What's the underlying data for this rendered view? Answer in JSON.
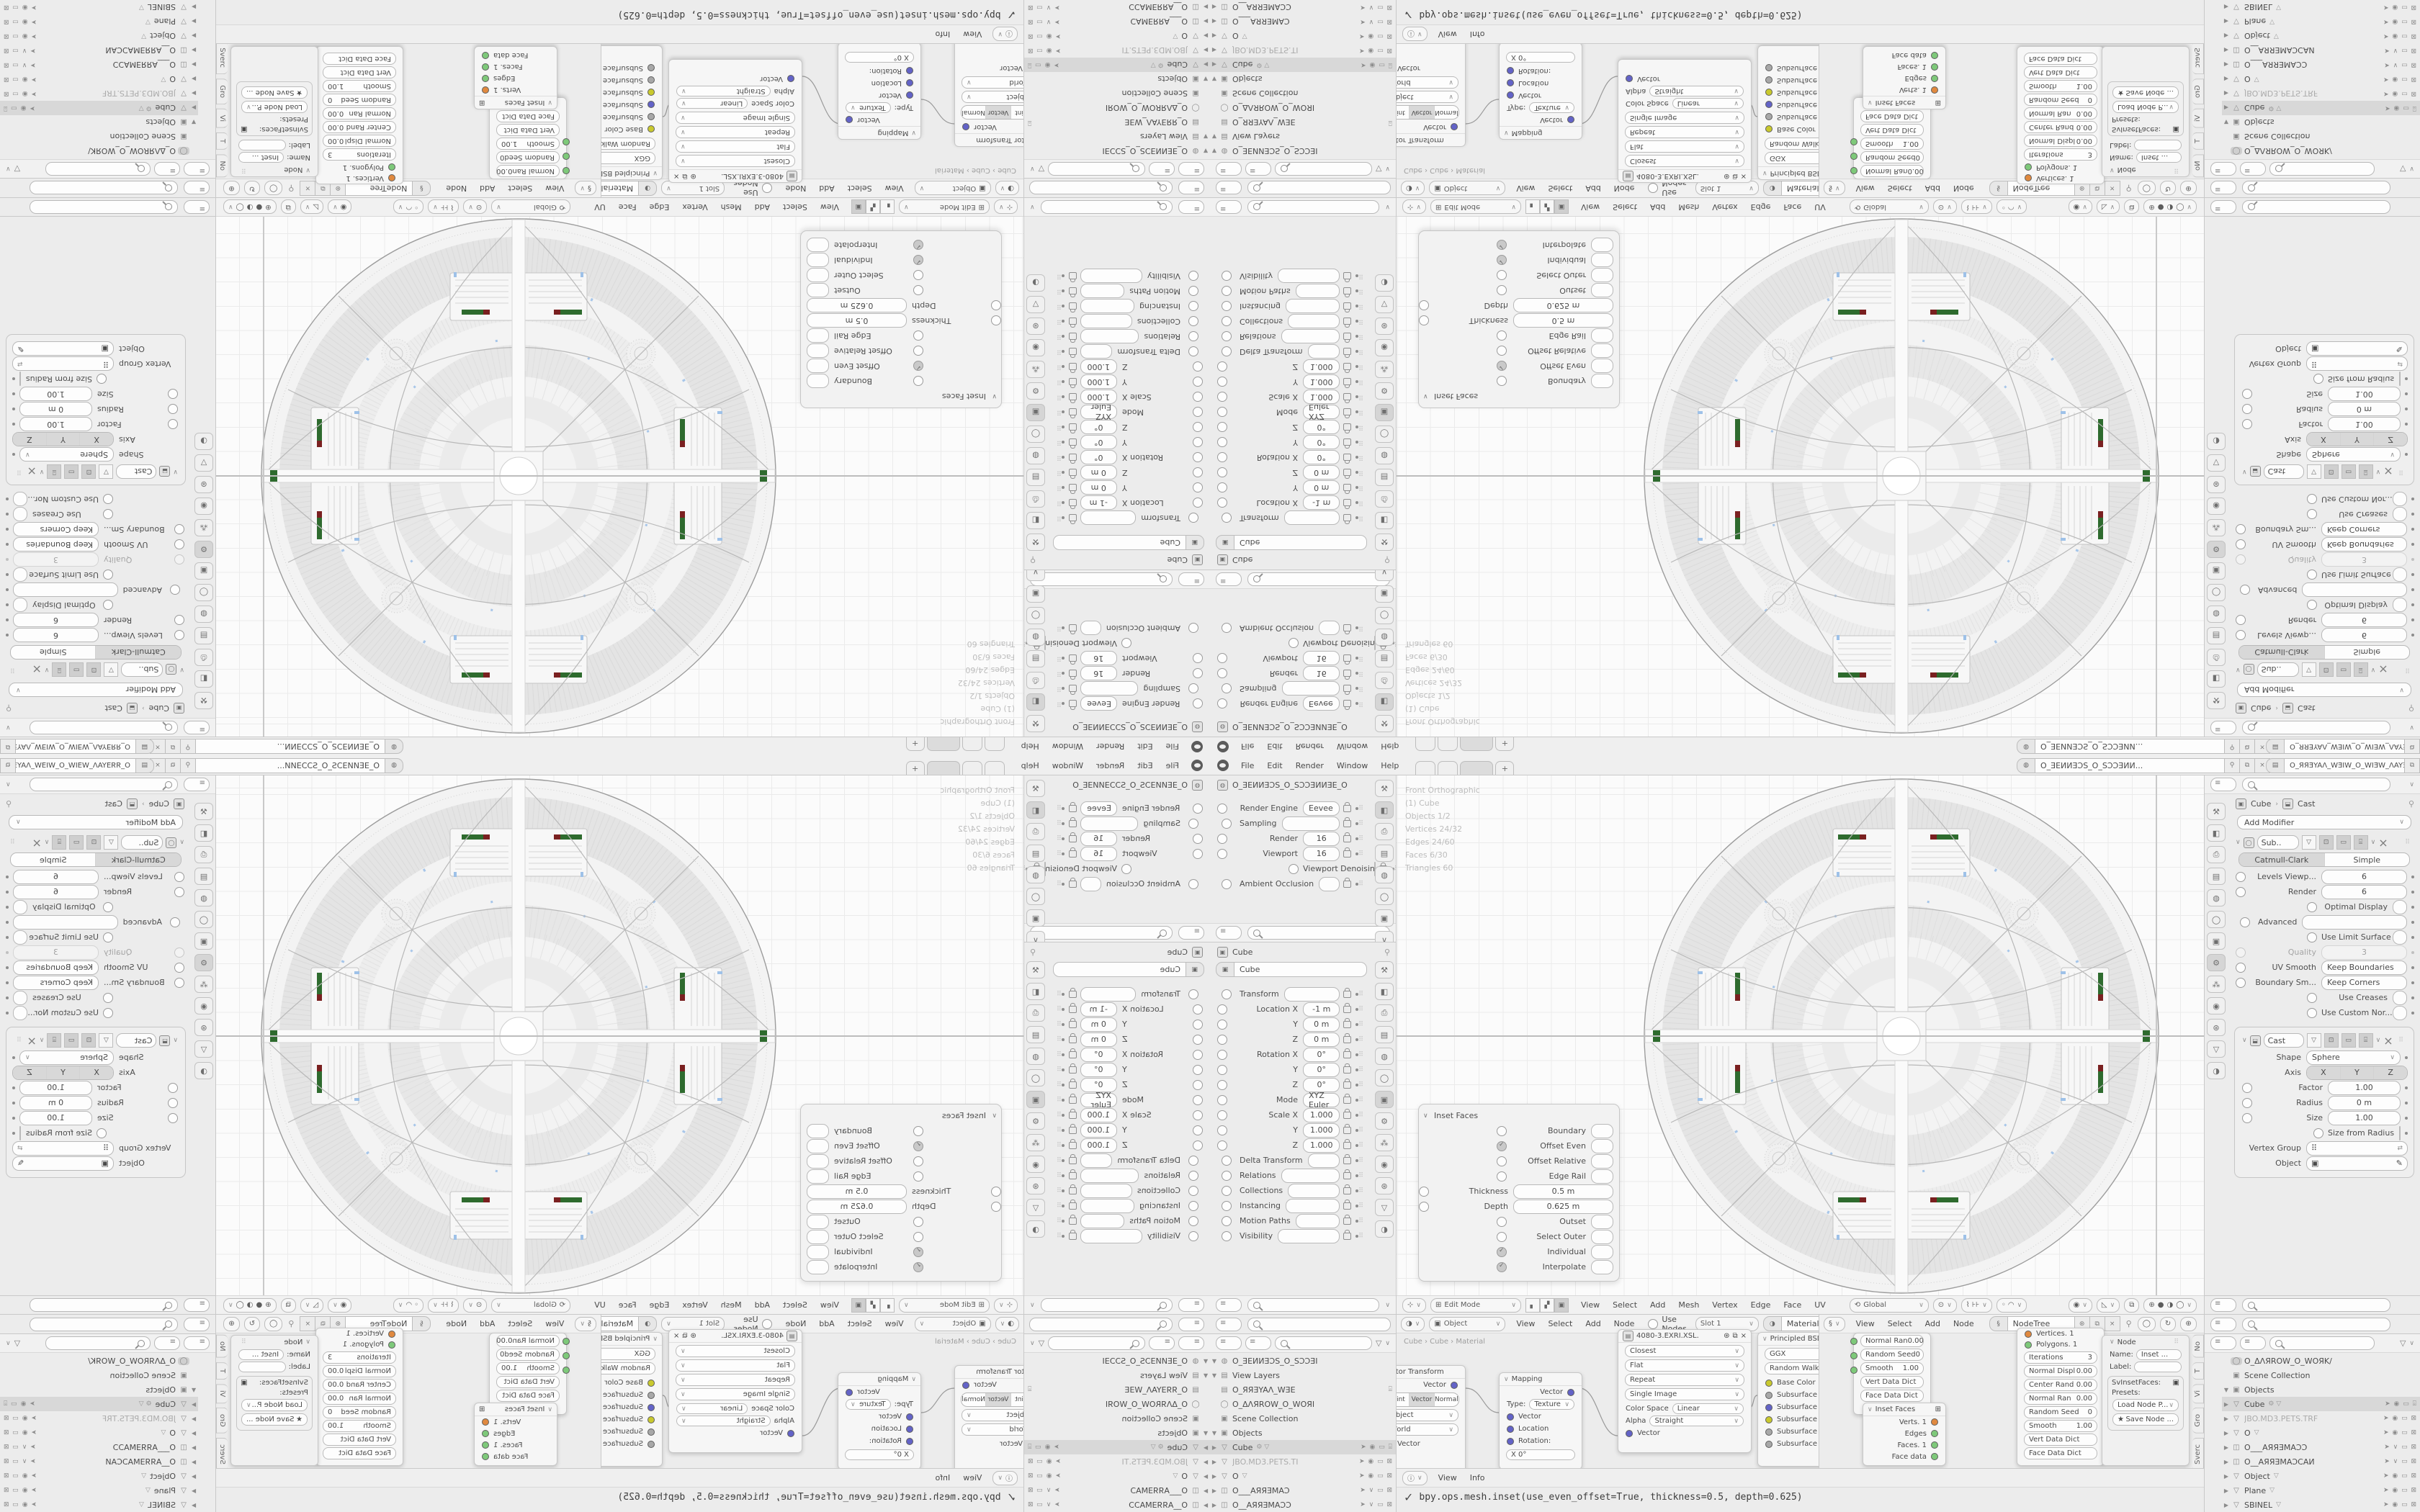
{
  "topbar": {
    "menus": [
      "File",
      "Edit",
      "Render",
      "Window",
      "Help"
    ],
    "new_tab_label": "+",
    "scene_name": "O_ƎEИИƎƆS_O_SƆƆƎИИ...",
    "view_layer_name": "O_ЯЯƎYAΛ_WƎIW_O_WIƎW_ΛAYƎЯR_O"
  },
  "icons": {
    "scene_icon": "◍",
    "view_layer_icon": "▤",
    "pin_icon": "⚲",
    "copy_icon": "⧉",
    "close_icon": "×",
    "chevron_down": "∨",
    "collapse_right": "›",
    "grip": "⠿",
    "caret_open": "∨",
    "shading_modes": [
      "⊕",
      "●",
      "◑",
      "◯"
    ],
    "gizmo_icon": "◉",
    "overlay_icon": "◺",
    "xray_icon": "⧉",
    "info_icon": "ⓘ",
    "check_icon": "✓",
    "helix_icon": "§",
    "star_icon": "★"
  },
  "tabs": {
    "render_strip": [
      {
        "g": "⚒"
      },
      {
        "g": "◧",
        "cls": "on"
      },
      {
        "g": "⎙"
      },
      {
        "g": "▤"
      },
      {
        "g": "◍"
      },
      {
        "g": "◯"
      },
      {
        "g": "▣"
      },
      {
        "g": "∨"
      }
    ],
    "object_strip": [
      {
        "g": "⚒"
      },
      {
        "g": "◧"
      },
      {
        "g": "⎙"
      },
      {
        "g": "▤"
      },
      {
        "g": "◍"
      },
      {
        "g": "◯"
      },
      {
        "g": "▣",
        "cls": "on"
      },
      {
        "g": "⚙"
      },
      {
        "g": "⁂"
      },
      {
        "g": "◉"
      },
      {
        "g": "⊛"
      },
      {
        "g": "▽"
      },
      {
        "g": "◑"
      }
    ],
    "modifier_strip": [
      {
        "g": "⚒"
      },
      {
        "g": "◧"
      },
      {
        "g": "⎙"
      },
      {
        "g": "▤"
      },
      {
        "g": "◍"
      },
      {
        "g": "◯"
      },
      {
        "g": "▣"
      },
      {
        "g": "⚙",
        "cls": "on"
      },
      {
        "g": "⁂"
      },
      {
        "g": "◉"
      },
      {
        "g": "⊛"
      },
      {
        "g": "▽"
      },
      {
        "g": "◑"
      }
    ]
  },
  "render_props": {
    "breadcrumb": "O_ƎEИИƎƆS_O_SƆƆƎИИƎE_O",
    "rows": [
      {
        "cls": "drop",
        "l": "Render Engine",
        "v": "Eevee"
      },
      {
        "cls": "head",
        "l": "Sampling"
      },
      {
        "cls": "num",
        "l": "Render",
        "v": "16"
      },
      {
        "cls": "num",
        "l": "Viewport",
        "v": "16"
      },
      {
        "cls": "chk",
        "l": "Viewport Denoising"
      },
      {
        "cls": "col chk",
        "l": "Ambient Occlusion"
      }
    ]
  },
  "object_props": {
    "breadcrumb": "Cube",
    "name_value": "Cube",
    "rows": [
      {
        "cls": "head",
        "l": "Transform"
      },
      {
        "cls": "num lk dot",
        "l": "Location X",
        "v": "-1 m"
      },
      {
        "cls": "num lk dot",
        "l": "Y",
        "v": "0 m"
      },
      {
        "cls": "num lk dot",
        "l": "Z",
        "v": "0 m"
      },
      {
        "cls": "num lk dot",
        "l": "Rotation X",
        "v": "0°"
      },
      {
        "cls": "num lk dot",
        "l": "Y",
        "v": "0°"
      },
      {
        "cls": "num lk dot",
        "l": "Z",
        "v": "0°"
      },
      {
        "cls": "drop dot",
        "l": "Mode",
        "v": "XYZ Euler"
      },
      {
        "cls": "num lk dot",
        "l": "Scale X",
        "v": "1.000"
      },
      {
        "cls": "num lk dot",
        "l": "Y",
        "v": "1.000"
      },
      {
        "cls": "num lk dot",
        "l": "Z",
        "v": "1.000"
      },
      {
        "cls": "col",
        "l": "Delta Transform"
      },
      {
        "cls": "col",
        "l": "Relations"
      },
      {
        "cls": "col",
        "l": "Collections"
      },
      {
        "cls": "col",
        "l": "Instancing"
      },
      {
        "cls": "col",
        "l": "Motion Paths"
      },
      {
        "cls": "col",
        "l": "Visibility"
      }
    ]
  },
  "modifier_props": {
    "breadcrumb_object": "Cube",
    "breadcrumb_modifier": "Cast",
    "add_modifier_label": "Add Modifier",
    "subsurf_name": "Sub..",
    "subsurf_tabs": [
      {
        "t": "Catmull-Clark",
        "cls": "on"
      },
      {
        "t": "Simple"
      }
    ],
    "subsurf_rows": [
      {
        "cls": "num dot",
        "l": "Levels Viewp...",
        "v": "6"
      },
      {
        "cls": "num dot",
        "l": "Render",
        "v": "6"
      },
      {
        "cls": "chk dot",
        "l": "Optimal Display"
      },
      {
        "cls": "head",
        "l": "Advanced"
      },
      {
        "cls": "chk dot",
        "l": "Use Limit Surface"
      },
      {
        "cls": "num dim",
        "l": "Quality",
        "v": "3"
      },
      {
        "cls": "drop dot",
        "l": "UV Smooth",
        "v": "Keep Boundaries"
      },
      {
        "cls": "drop dot",
        "l": "Boundary Sm...",
        "v": "Keep Corners"
      },
      {
        "cls": "chk dot",
        "l": "Use Creases"
      },
      {
        "cls": "chk dot",
        "l": "Use Custom Nor..."
      }
    ],
    "cast_name": "Cast",
    "cast_shape_row": {
      "l": "Shape",
      "v": "Sphere"
    },
    "cast_axis_label": "Axis",
    "cast_axis": [
      {
        "t": "X",
        "cls": "on"
      },
      {
        "t": "Y",
        "cls": "on"
      },
      {
        "t": "Z",
        "cls": "on"
      }
    ],
    "cast_rows": [
      {
        "cls": "num fill dot",
        "l": "Factor",
        "v": "1.00"
      },
      {
        "cls": "num dot",
        "l": "Radius",
        "v": "0 m"
      },
      {
        "cls": "num dot",
        "l": "Size",
        "v": "1.00"
      },
      {
        "cls": "chk dot",
        "l": "Size from Radius"
      }
    ],
    "vertex_group_label": "Vertex Group",
    "object_label": "Object"
  },
  "viewport": {
    "stats": [
      "Front Orthographic",
      "(1) Cube",
      "Objects 1/2",
      "Vertices 24/32",
      "Edges 24/60",
      "Faces 6/30",
      "Triangles 60"
    ],
    "mode": "Edit Mode",
    "menus": [
      "View",
      "Select",
      "Add",
      "Mesh",
      "Vertex",
      "Edge",
      "Face",
      "UV"
    ],
    "orientation": "Global",
    "inset_panel": {
      "title": "Inset Faces",
      "rows": [
        {
          "cls": "chk",
          "l": "Boundary"
        },
        {
          "cls": "chk on",
          "l": "Offset Even"
        },
        {
          "cls": "chk",
          "l": "Offset Relative"
        },
        {
          "cls": "chk",
          "l": "Edge Rail"
        },
        {
          "cls": "num",
          "l": "Thickness",
          "v": "0.5 m"
        },
        {
          "cls": "num",
          "l": "Depth",
          "v": "0.625 m"
        },
        {
          "cls": "chk",
          "l": "Outset"
        },
        {
          "cls": "chk",
          "l": "Select Outer"
        },
        {
          "cls": "chk on",
          "l": "Individual"
        },
        {
          "cls": "chk on",
          "l": "Interpolate"
        }
      ]
    }
  },
  "shader_editor": {
    "shader_type": "Object",
    "menus": [
      "View",
      "Select",
      "Add",
      "Node"
    ],
    "use_nodes_label": "Use Nodes",
    "slot": "Slot 1",
    "material": "Material",
    "breadcrumb": "Cube  ›  Cube  ›  Material",
    "vector_transform": {
      "title": "Vector Transform",
      "output": "Vector",
      "seg": [
        {
          "t": "Point"
        },
        {
          "t": "Vector",
          "cls": "on"
        },
        {
          "t": "Normal"
        }
      ],
      "drop1": "Object",
      "drop2": "World",
      "input": "Vector"
    },
    "mapping": {
      "title": "Mapping",
      "output": "Vector",
      "type_label": "Type:",
      "type_value": "Texture",
      "inputs": [
        "Vector",
        "Location",
        "Rotation:"
      ],
      "x_value": "X            0°"
    },
    "image_texture": {
      "name": "4080-3.EXRI.XSL.",
      "drops": [
        "Closest",
        "Flat",
        "Repeat",
        "Single Image"
      ],
      "color_space_label": "Color Space",
      "color_space": "Linear",
      "alpha_label": "Alpha",
      "alpha": "Straight",
      "input": "Vector"
    },
    "principled": {
      "title": "Principled BSDF",
      "drop1": "GGX",
      "drop2": "Random Walk",
      "sockets": [
        {
          "l": "Base Color",
          "c": "sy"
        },
        {
          "l": "Subsurface",
          "c": "sgr"
        },
        {
          "l": "Subsurface Radi...",
          "c": "sb"
        },
        {
          "l": "Subsurface Color",
          "c": "sy"
        },
        {
          "l": "Subsurface IOR",
          "c": "sgr"
        },
        {
          "l": "Subsurface Anis...",
          "c": "sgr"
        }
      ]
    }
  },
  "sv_editor": {
    "menus": [
      "View",
      "Select",
      "Add",
      "Node"
    ],
    "tree_name": "NodeTree",
    "param_node_rows": [
      {
        "l": "Normal Ran",
        "v": "0.00"
      },
      {
        "l": "Random Seed",
        "v": "0"
      },
      {
        "l": "Smooth",
        "v": "1.00"
      },
      {
        "l": "Vert Data Dict",
        "v": ""
      },
      {
        "l": "Face Data Dict",
        "v": ""
      }
    ],
    "inset_node_title": "Inset Faces",
    "inset_node_outputs": [
      {
        "l": "Verts. 1",
        "c": "so"
      },
      {
        "l": "Edges",
        "c": "sg"
      },
      {
        "l": "Faces. 1",
        "c": "sg"
      },
      {
        "l": "Face data",
        "c": "sg"
      }
    ],
    "big_node_outputs": [
      {
        "l": "Vertices. 1",
        "c": "so"
      },
      {
        "l": "Polygons. 1",
        "c": "sg"
      }
    ],
    "big_node_rows": [
      {
        "l": "Iterations",
        "v": "3"
      },
      {
        "l": "Normal Displ",
        "v": "0.00"
      },
      {
        "l": "Center Rand",
        "v": "0.00"
      },
      {
        "l": "Normal Ran",
        "v": "0.00"
      },
      {
        "l": "Random Seed",
        "v": "0"
      },
      {
        "l": "Smooth",
        "v": "1.00"
      },
      {
        "l": "Vert Data Dict",
        "v": ""
      },
      {
        "l": "Face Data Dict",
        "v": ""
      }
    ],
    "n_panel": {
      "title": "Node",
      "name_label": "Name:",
      "name_value": "Inset ...",
      "label_label": "Label:",
      "preset_box_label": "SvInsetFaces:",
      "presets_label": "Presets:",
      "load_label": "Load Node P...",
      "save_label": "Save Node ...",
      "tabs": [
        "No",
        "T",
        "Vi",
        "Gro",
        "Sverc"
      ]
    }
  },
  "info_editor": {
    "menus": [
      "View",
      "Info"
    ],
    "log": "bpy.ops.mesh.inset(use_even_offset=True, thickness=0.5, depth=0.625)"
  },
  "outliner_left": {
    "rows": [
      {
        "c": "▼",
        "g": "◍",
        "l": "O_ƎEИИƎƆS_O_SƆƆƎI",
        "i": 0
      },
      {
        "c": "▼",
        "g": "▤",
        "l": "View Layers",
        "i": 1
      },
      {
        "g": "▤",
        "l": "O_ЯЯƎYAΛ_WƎE",
        "i": 2,
        "r": "⌻"
      },
      {
        "g": "◯",
        "l": "O_ΔΛЯROW_O_WOЯI",
        "i": 1
      },
      {
        "g": "▣",
        "l": "Scene Collection",
        "i": 1
      },
      {
        "c": "▼",
        "g": "▣",
        "l": "Objects",
        "i": 1
      },
      {
        "c": "▶",
        "g": "▽",
        "l": "Cube",
        "i": 2,
        "cls": "sel",
        "x": "⚙ ▽",
        "r": "➤ ◉ ▭ ⌻"
      },
      {
        "c": "▶",
        "g": "▽",
        "l": "JBO.MD3.PETS.TI",
        "i": 2,
        "cls": "dim",
        "r": "➤ ◉ ▭ ⊠"
      },
      {
        "c": "▶",
        "g": "▽",
        "l": "O",
        "i": 2,
        "x": "▽",
        "r": "➤ ◉ ▭ ⊠"
      },
      {
        "c": "▶",
        "g": "◫",
        "l": "O___AЯЯƎMAƆ",
        "i": 2,
        "r": "➤ ∨ ▭ ⊠"
      },
      {
        "c": "▶",
        "g": "◫",
        "l": "O__AЯЯƎMAƆƆ",
        "i": 2,
        "r": "➤ ∨ ▭ ⊠"
      }
    ]
  },
  "outliner_right": {
    "rows": [
      {
        "g": "◯",
        "l": "O_ΔΛЯROW_O_WOЯK/",
        "i": 1,
        "cls": "wsel"
      },
      {
        "g": "▣",
        "l": "Scene Collection",
        "i": 1
      },
      {
        "c": "▼",
        "g": "▣",
        "l": "Objects",
        "i": 1
      },
      {
        "c": "▶",
        "g": "▽",
        "l": "Cube",
        "i": 2,
        "cls": "sel",
        "x": "⚙ ▽",
        "r": "➤ ◉ ▭ ⌻"
      },
      {
        "c": "▶",
        "g": "▽",
        "l": "JBO.MD3.PETS.TRF",
        "i": 2,
        "cls": "dim",
        "r": "➤ ◉ ▭ ⊠"
      },
      {
        "c": "▶",
        "g": "▽",
        "l": "O",
        "i": 2,
        "x": "▽",
        "r": "➤ ◉ ▭ ⊠"
      },
      {
        "c": "▶",
        "g": "◫",
        "l": "O___AЯЯƎMAƆƆ",
        "i": 2,
        "r": "➤ ∨ ▭ ⊠"
      },
      {
        "c": "▶",
        "g": "◫",
        "l": "O__AЯЯƎMAƆCAИ",
        "i": 2,
        "r": "➤ ∨ ▭ ⊠"
      },
      {
        "c": "▶",
        "g": "▽",
        "l": "Object",
        "i": 2,
        "x": "▽",
        "r": "➤ ◉ ▭ ⊠"
      },
      {
        "c": "▶",
        "g": "▽",
        "l": "Plane",
        "i": 2,
        "x": "▽",
        "r": "➤ ◉ ▭ ⊠"
      },
      {
        "c": "▶",
        "g": "▽",
        "l": "SBINEL",
        "i": 2,
        "x": "▽",
        "r": "➤ ◉ ▭ ⊠"
      }
    ]
  },
  "colors": {
    "accent_green": "#2e6b2e",
    "accent_red": "#7a2020",
    "accent_blue": "#9ec1e8",
    "axis_gray": "#bdbdbd"
  }
}
